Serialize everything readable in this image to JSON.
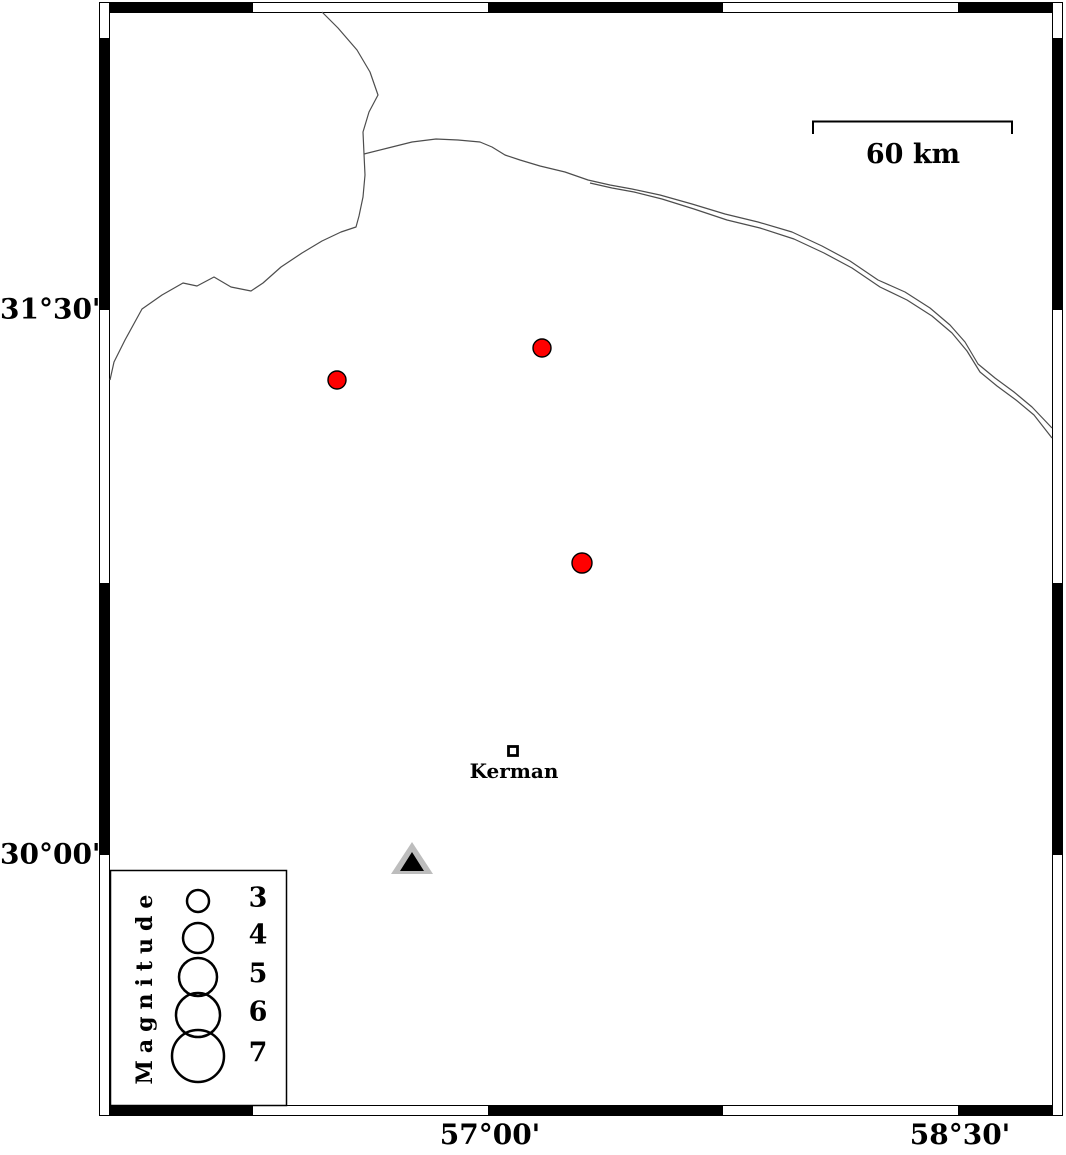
{
  "figure_type": "seismicity-map",
  "frame": {
    "latitude_ticks": [
      {
        "label": "31°30'",
        "y_px": 310
      },
      {
        "label": "30°00'",
        "y_px": 855
      }
    ],
    "longitude_ticks": [
      {
        "label": "57°00'",
        "x_px": 490
      },
      {
        "label": "58°30'",
        "x_px": 960
      }
    ]
  },
  "scale_bar": {
    "label": "60 km",
    "x1_px": 813,
    "x2_px": 1012,
    "y_px": 122
  },
  "city": {
    "name": "Kerman",
    "marker_x_px": 513,
    "marker_y_px": 751
  },
  "legend": {
    "title": "Magnitude",
    "circle_cx_px": 198,
    "label_cx_px": 258,
    "entries": [
      {
        "label": "3",
        "radius_px": 11,
        "cy_px": 901
      },
      {
        "label": "4",
        "radius_px": 15,
        "cy_px": 938
      },
      {
        "label": "5",
        "radius_px": 19,
        "cy_px": 977
      },
      {
        "label": "6",
        "radius_px": 22,
        "cy_px": 1015
      },
      {
        "label": "7",
        "radius_px": 26,
        "cy_px": 1056
      }
    ]
  },
  "earthquakes": [
    {
      "cx_px": 337,
      "cy_px": 380,
      "radius_px": 9
    },
    {
      "cx_px": 542,
      "cy_px": 348,
      "radius_px": 9
    },
    {
      "cx_px": 582,
      "cy_px": 563,
      "radius_px": 10
    }
  ],
  "station": {
    "apex_x_px": 412,
    "apex_y_px": 842
  },
  "colors": {
    "earthquake_fill": "#ff0000",
    "marker_outline": "#000000",
    "station_fill": "#bdbdbd",
    "station_inner_fill": "#000000",
    "road_stroke": "#4d4d4d",
    "frame_color": "#000000",
    "background": "#ffffff"
  }
}
